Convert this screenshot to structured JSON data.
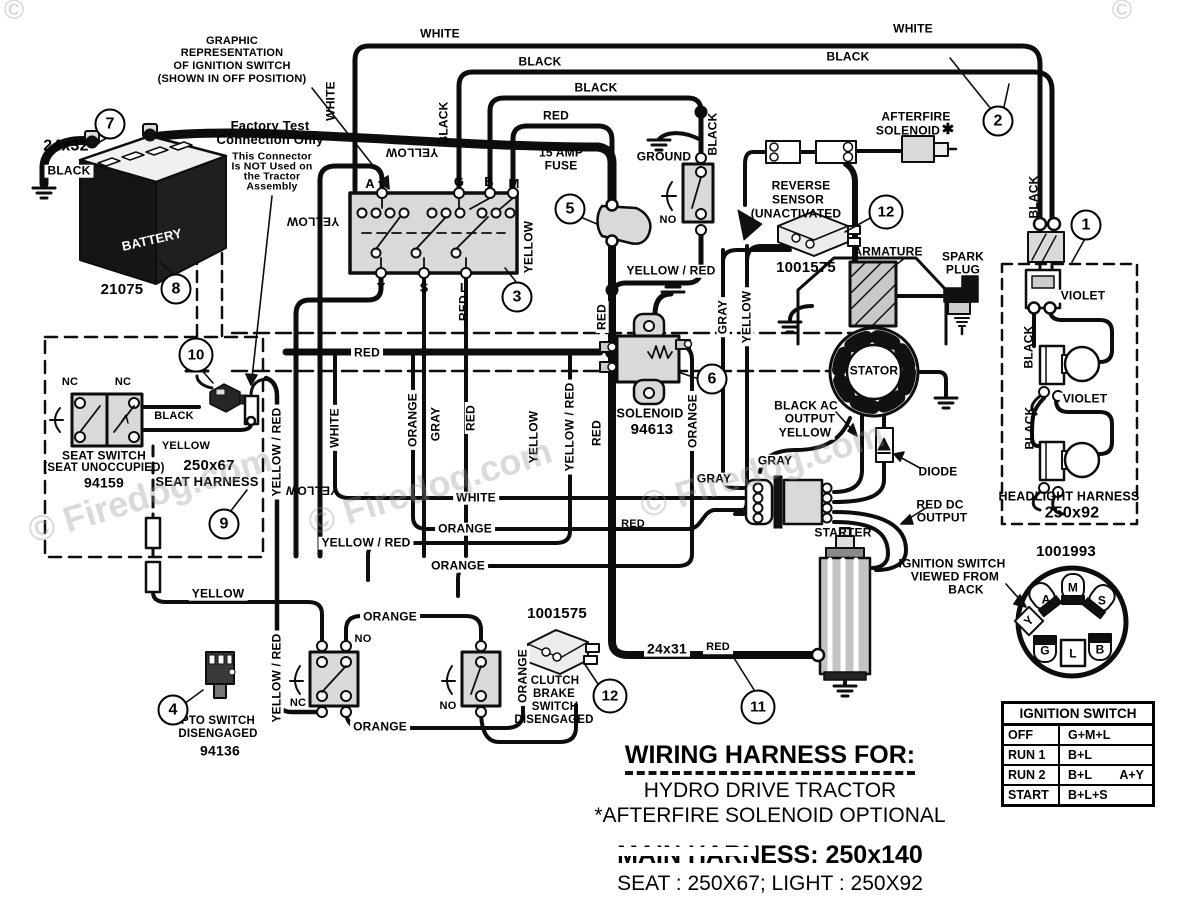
{
  "notes": {
    "gr1": "GRAPHIC",
    "gr2": "REPRESENTATION",
    "gr3": "OF IGNITION SWITCH",
    "gr4": "(SHOWN IN OFF POSITION)",
    "ft1": "Factory Test",
    "ft2": "Connection Only",
    "fn1": "This Connector",
    "fn2": "Is NOT Used on",
    "fn3": "the Tractor",
    "fn4": "Assembly"
  },
  "wires": {
    "cable_bat": "24x32",
    "black_bat": "BLACK",
    "white_tl": "WHITE",
    "black_tl": "BLACK",
    "black_mid": "BLACK",
    "red_top": "RED",
    "black_tr": "BLACK",
    "white_tr": "WHITE",
    "white_v_ign": "WHITE",
    "yellow_v_ign": "YELLOW",
    "yellow_h_ign": "YELLOW",
    "black_v_ign": "BLACK",
    "yellow_v_ign_r": "YELLOW",
    "red_v_ign_b": "RED",
    "black_v_sw": "BLACK",
    "no_sw": "NO",
    "ground": "GROUND",
    "yellow_red_sol": "YELLOW / RED",
    "nc_seat_l": "NC",
    "nc_seat_r": "NC",
    "black_seat": "BLACK",
    "yellow_seat": "YELLOW",
    "yellow_red_v_seat": "YELLOW / RED",
    "yellow_v_seat": "YELLOW",
    "red_bus": "RED",
    "white_v_mid": "WHITE",
    "orange_v_mid": "ORANGE",
    "gray_v_mid": "GRAY",
    "red_v_mid": "RED",
    "yellow_v_mid": "YELLOW",
    "yellow_red_v_mid": "YELLOW / RED",
    "red_v_sol_t": "RED",
    "red_v_sol_b": "RED",
    "red_h_sol": "RED",
    "orange_v_sol": "ORANGE",
    "gray_v_r": "GRAY",
    "yellow_v_r": "YELLOW",
    "white_run": "WHITE",
    "orange_run1": "ORANGE",
    "yellow_red_run": "YELLOW / RED",
    "orange_run2": "ORANGE",
    "gray_h1": "GRAY",
    "gray_h2": "GRAY",
    "yellow_ac": "YELLOW",
    "black_ac1": "BLACK AC",
    "black_ac2": "OUTPUT",
    "red_dc1": "RED DC",
    "red_dc2": "OUTPUT",
    "yellow_bot": "YELLOW",
    "orange_pto_t": "ORANGE",
    "orange_pto_b": "ORANGE",
    "no_pto": "NO",
    "nc_pto": "NC",
    "no_brake": "NO",
    "yellow_red_v_bot": "YELLOW / RED",
    "orange_v_cb": "ORANGE",
    "cable_starter": "24x31",
    "red_starter": "RED",
    "black_v_hl": "BLACK",
    "violet1": "VIOLET",
    "violet2": "VIOLET",
    "black_hl1": "BLACK",
    "black_hl2": "BLACK"
  },
  "parts": {
    "battery": "BATTERY",
    "battery_pn": "21075",
    "fuse1": "15 AMP",
    "fuse2": "FUSE",
    "afterfire1": "AFTERFIRE",
    "afterfire2": "SOLENOID",
    "star": "✱",
    "reverse1": "REVERSE",
    "reverse2": "SENSOR",
    "reverse3": "(UNACTIVATED",
    "reverse_pn": "1001575",
    "armature": "ARMATURE",
    "spark1": "SPARK",
    "spark2": "PLUG",
    "stator": "STATOR",
    "diode": "DIODE",
    "starter": "STARTER",
    "solenoid": "SOLENOID",
    "solenoid_pn": "94613",
    "seat1": "SEAT SWITCH",
    "seat2": "(SEAT UNOCCUPIED)",
    "seat_pn": "94159",
    "harness1": "250x67",
    "harness2": "SEAT HARNESS",
    "pto1": "PTO SWITCH",
    "pto2": "DISENGAGED",
    "pto_pn": "94136",
    "cb_pn": "1001575",
    "cb1": "CLUTCH",
    "cb2": "BRAKE",
    "cb3": "SWITCH",
    "cb4": "DISENGAGED",
    "hl1": "HEADLIGHT HARNESS",
    "hl2": "250x92",
    "key_pn": "1001993",
    "kv1": "IGNITION SWITCH",
    "kv2": "VIEWED FROM",
    "kv3": "BACK"
  },
  "ign_terms": {
    "a": "A",
    "g": "G",
    "b": "B",
    "m": "M",
    "y": "Y",
    "s": "S",
    "l": "L"
  },
  "key_terms": {
    "a": "A",
    "m": "M",
    "s": "S",
    "y": "Y",
    "g": "G",
    "l": "L",
    "b": "B"
  },
  "callouts": {
    "c1": "1",
    "c2": "2",
    "c3": "3",
    "c4": "4",
    "c5": "5",
    "c6": "6",
    "c7": "7",
    "c8": "8",
    "c9": "9",
    "c10": "10",
    "c11": "11",
    "c12_sensor": "12",
    "c12_brake": "12"
  },
  "table": {
    "title": "IGNITION SWITCH",
    "rows": [
      {
        "pos": "OFF",
        "main": "G+M+L",
        "alt": ""
      },
      {
        "pos": "RUN 1",
        "main": "B+L",
        "alt": ""
      },
      {
        "pos": "RUN 2",
        "main": "B+L",
        "alt": "A+Y"
      },
      {
        "pos": "START",
        "main": "B+L+S",
        "alt": ""
      }
    ]
  },
  "titles": {
    "t1": "WIRING HARNESS FOR:",
    "t2": "HYDRO DRIVE TRACTOR",
    "t3": "*AFTERFIRE SOLENOID OPTIONAL",
    "t4": "MAIN HARNESS: 250x140",
    "t5": "SEAT : 250X67;    LIGHT : 250X92"
  },
  "watermark": "© Firedog.com",
  "watermark_short": "©"
}
